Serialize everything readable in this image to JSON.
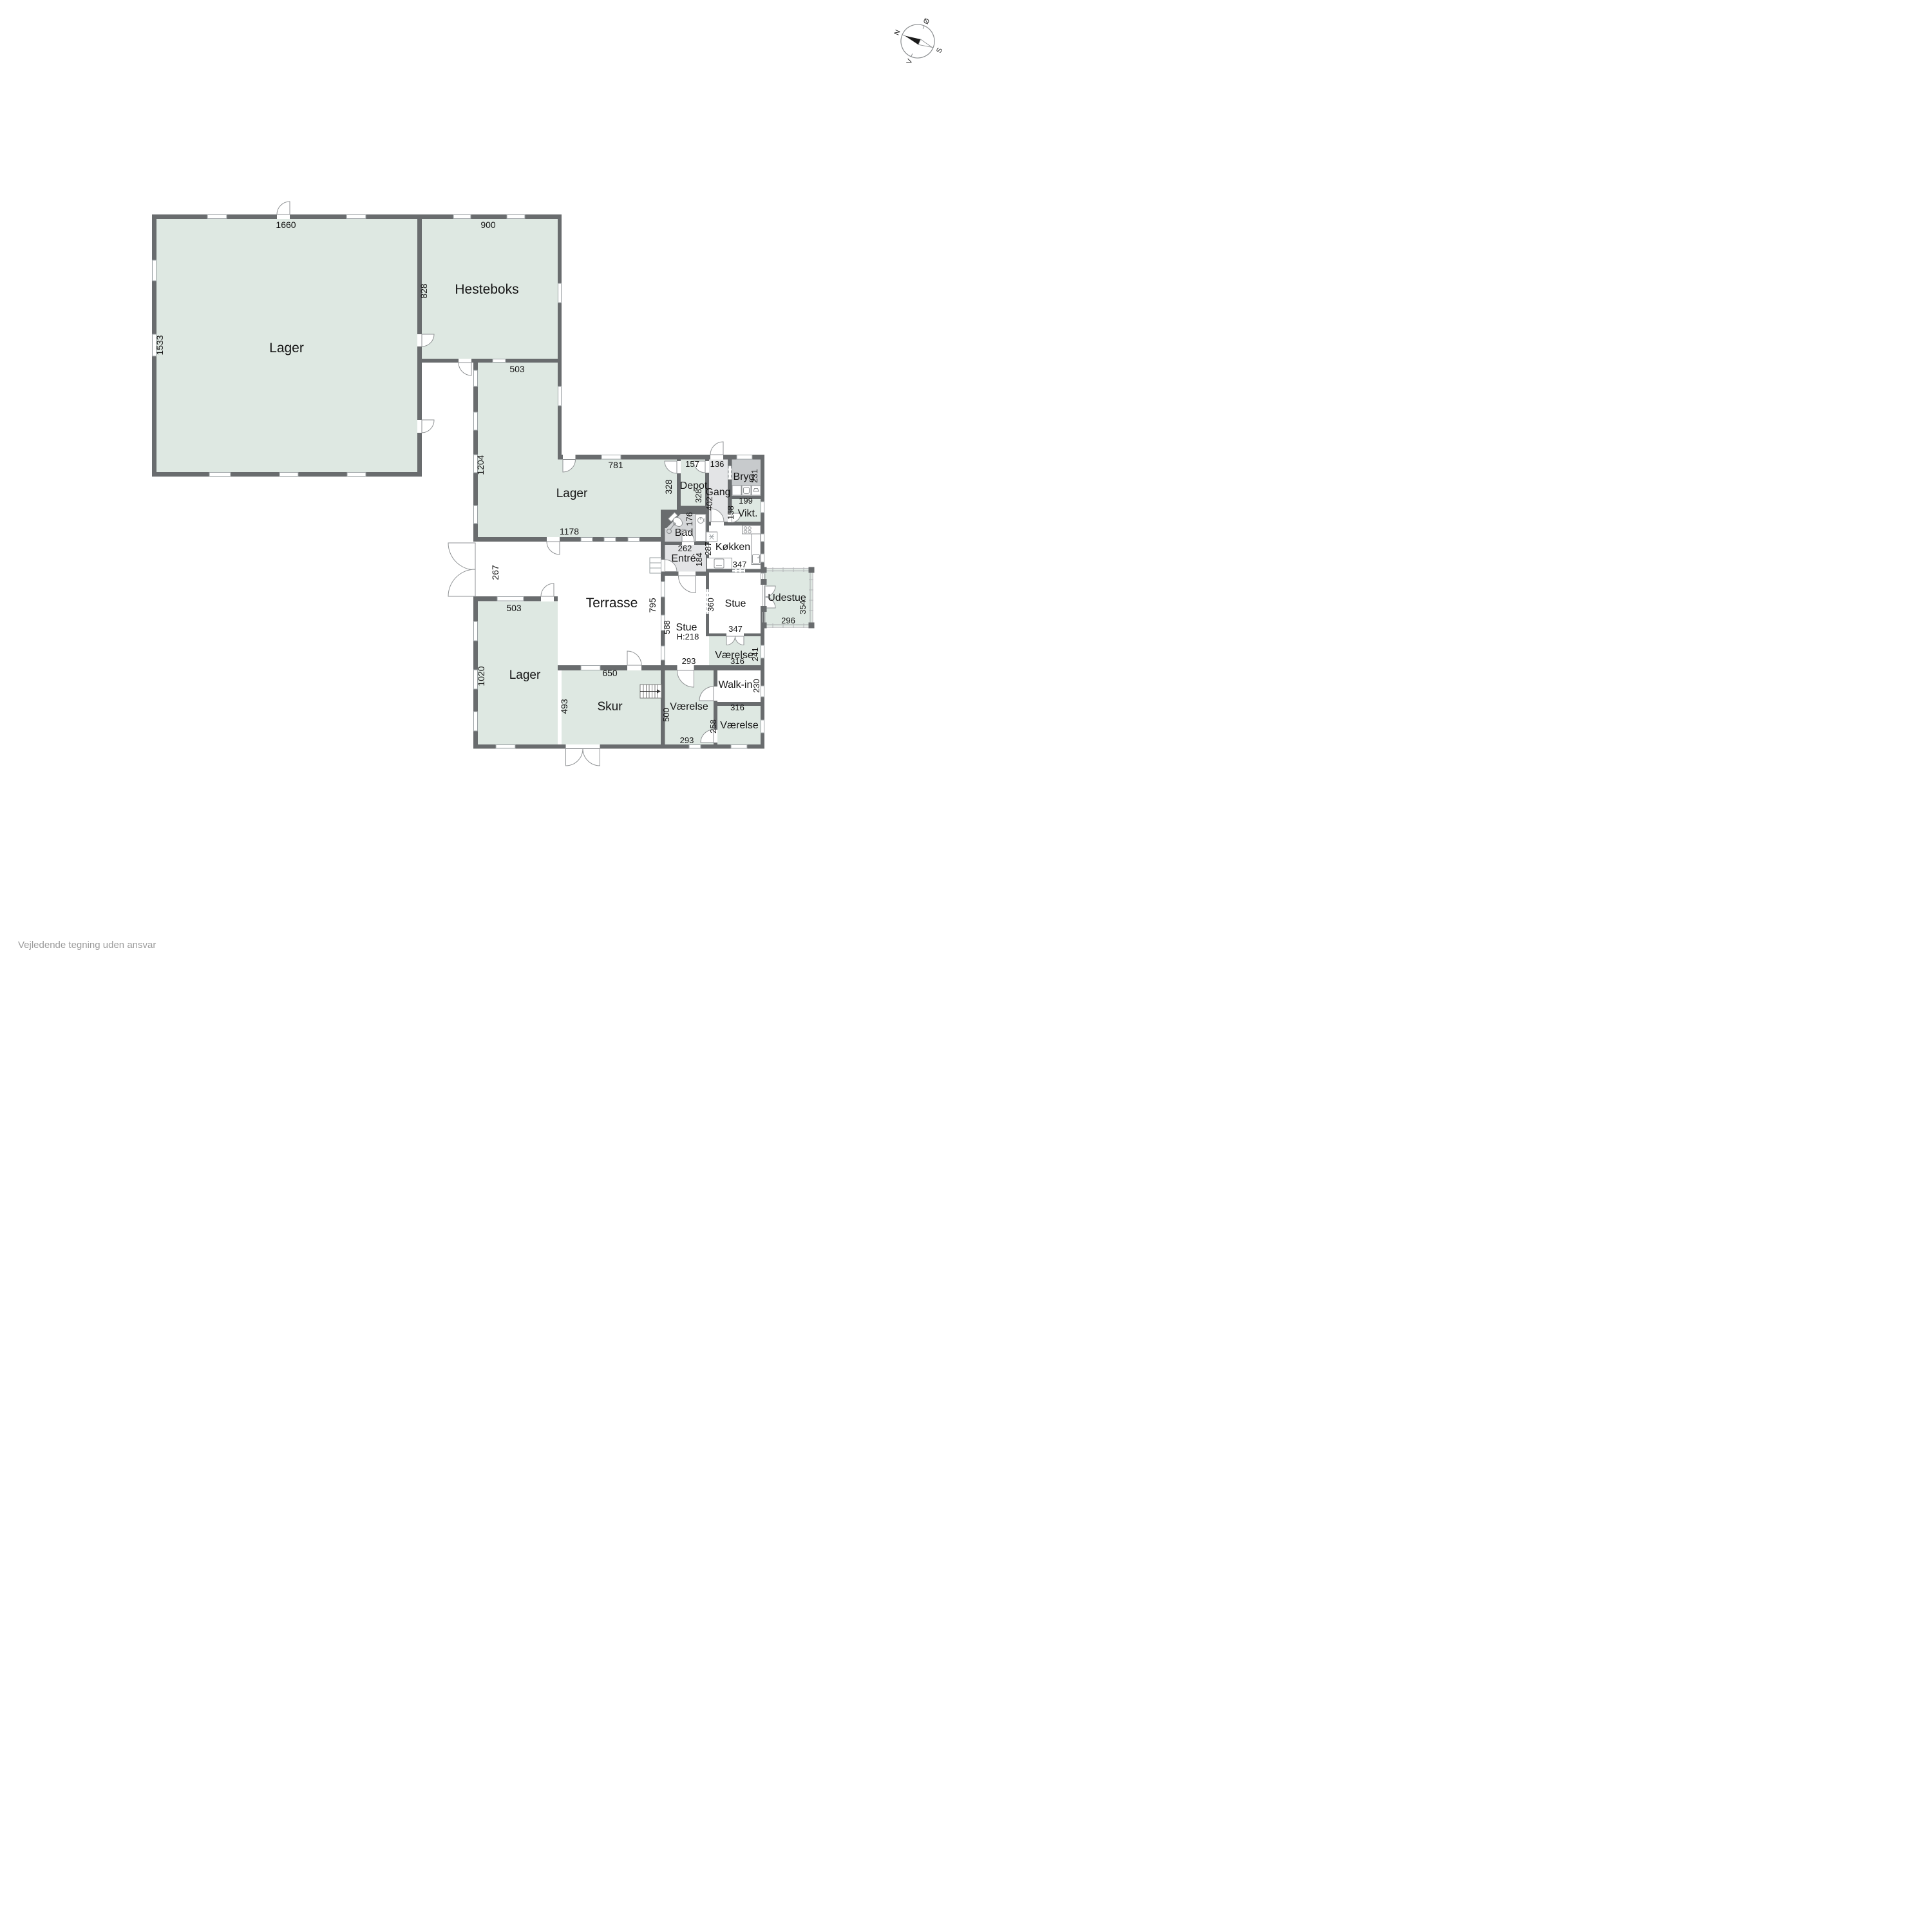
{
  "note": "Vejledende tegning uden ansvar",
  "compass": {
    "n": "N",
    "o": "Ø",
    "s": "S",
    "v": "V"
  },
  "rooms": {
    "lager_big": "Lager",
    "hesteboks": "Hesteboks",
    "lager_mid": "Lager",
    "lager_bottom": "Lager",
    "depot": "Depot",
    "gang": "Gang",
    "bryg": "Bryg",
    "vikt": "Vikt.",
    "bad": "Bad",
    "koekken": "Køkken",
    "entre": "Entré",
    "stue_right": "Stue",
    "stue_main": "Stue",
    "stue_main_h": "H:218",
    "udestue": "Udestue",
    "terrasse": "Terrasse",
    "skur": "Skur",
    "vaerelse_mid": "Værelse",
    "vaerelse_right": "Værelse",
    "vaerelse_bottom": "Værelse",
    "walkin": "Walk-in"
  },
  "dims": {
    "d1660": "1660",
    "d1533": "1533",
    "d900": "900",
    "d828": "828",
    "d503_top": "503",
    "d1204": "1204",
    "d781": "781",
    "d328_lager": "328",
    "d157": "157",
    "d136": "136",
    "d328_depot": "328",
    "d402": "402",
    "d231": "231",
    "d199": "199",
    "d158": "158",
    "d176": "176",
    "d1178": "1178",
    "d262": "262",
    "d184": "184",
    "d287": "287",
    "d347_koekken": "347",
    "d267": "267",
    "d795": "795",
    "d588": "588",
    "d360": "360",
    "d347_stue": "347",
    "d354": "354",
    "d296": "296",
    "d503_bottom": "503",
    "d1020": "1020",
    "d650": "650",
    "d493": "493",
    "d500": "500",
    "d293_top": "293",
    "d293_bottom": "293",
    "d316_top": "316",
    "d316_mid": "316",
    "d230": "230",
    "d258": "258",
    "d241": "241"
  },
  "colors": {
    "wall": "#696c6e",
    "room_green": "#dee8e2",
    "room_gray": "#e3e4e6",
    "bad_gray": "#d4d6d8",
    "bryg_gray": "#c7cacc",
    "arc": "#8f9294"
  }
}
